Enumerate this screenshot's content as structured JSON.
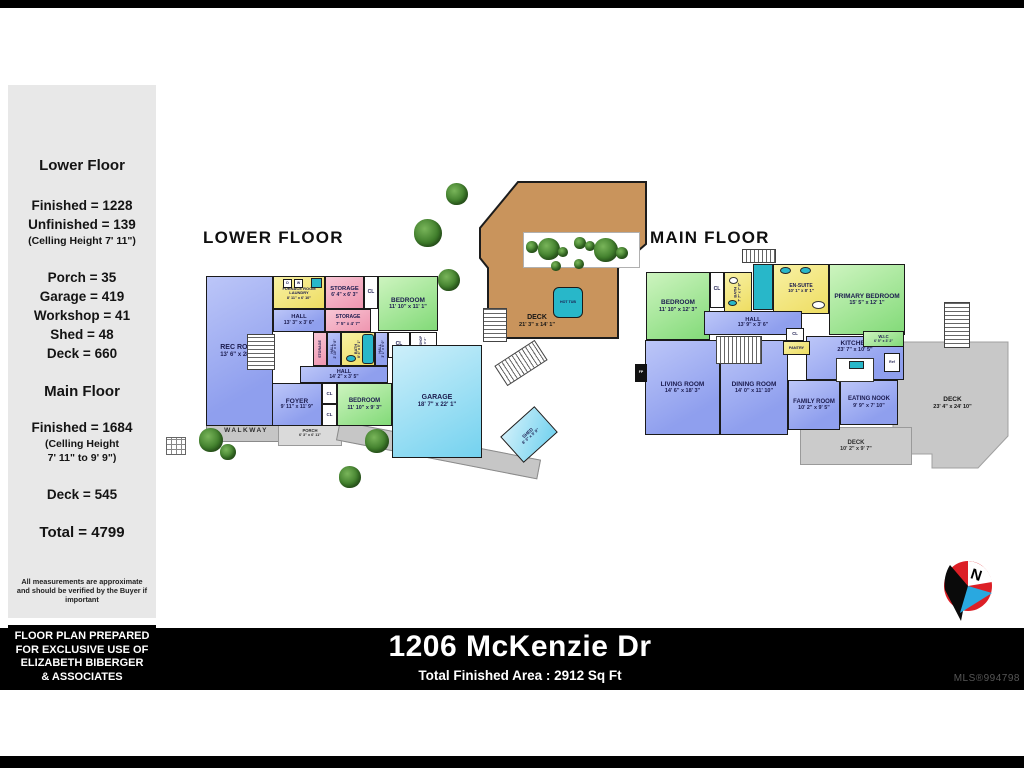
{
  "meta": {
    "address": "1206 McKenzie Dr",
    "total_area_label": "Total Finished Area : 2912 Sq Ft",
    "mls": "MLS®994798"
  },
  "palette": {
    "room_blue": "#8f9fee",
    "room_green": "#82da78",
    "room_yellow": "#eedd62",
    "room_pink": "#ef96b0",
    "room_cyan": "#74d2ef",
    "deck_tan": "#c9945c",
    "deck_gray": "#c8c8c8",
    "fixture_teal": "#28b7c9",
    "wall_black": "#1a1a1a"
  },
  "sidebar": {
    "lower": {
      "title": "Lower Floor",
      "lines": [
        "Finished = 1228",
        "Unfinished = 139"
      ],
      "note": "(Celling Height 7' 11\")",
      "lines2": [
        "Porch = 35",
        "Garage = 419",
        "Workshop = 41",
        "Shed = 48",
        "Deck = 660"
      ]
    },
    "main": {
      "title": "Main Floor",
      "lines": [
        "Finished = 1684"
      ],
      "note": [
        "(Celling Height",
        "7' 11\" to 9' 9\")"
      ],
      "lines2": [
        "Deck = 545"
      ]
    },
    "total": "Total = 4799",
    "disclaimer": "All measurements are approximate and should be verified by the Buyer if important"
  },
  "prepared_notice": [
    "FLOOR PLAN PREPARED",
    "FOR EXCLUSIVE USE OF",
    "ELIZABETH BIBERGER",
    "& ASSOCIATES"
  ],
  "compass": {
    "label": "N"
  },
  "floors": [
    {
      "id": "lower",
      "title": "LOWER FLOOR",
      "rooms": [
        {
          "id": "rec-room",
          "label": "REC ROOM",
          "dims": "13' 6\" x 28' 0\""
        },
        {
          "id": "furnace-laundry",
          "label": "FURNACE ROOM LAUNDRY",
          "dims": "8' 11\" x 6' 10\""
        },
        {
          "id": "storage-top",
          "label": "STORAGE",
          "dims": "6' 4\" x 6' 3\""
        },
        {
          "id": "cl-1",
          "label": "CL"
        },
        {
          "id": "bedroom-upper",
          "label": "BEDROOM",
          "dims": "11' 10\" x 11' 1\""
        },
        {
          "id": "hall-upper",
          "label": "HALL",
          "dims": "13' 3\" x 3' 6\""
        },
        {
          "id": "storage-mid",
          "label": "STORAGE",
          "dims": "7' 5\" x 4' 7\""
        },
        {
          "id": "storage-vert",
          "label": "STORAGE"
        },
        {
          "id": "hall-vert-left",
          "label": "HALL",
          "dims": "2' 10\" x 6' 8\""
        },
        {
          "id": "bath",
          "label": "BATH",
          "dims": "8' 4\" x 5' 1\""
        },
        {
          "id": "hall-vert-right",
          "label": "HALL",
          "dims": "3' 1\" x 6' 0\""
        },
        {
          "id": "cl-2",
          "label": "CL"
        },
        {
          "id": "workshop",
          "label": "WORKSHOP",
          "dims": "6' 4\" x 6' 2\""
        },
        {
          "id": "hall-lower",
          "label": "HALL",
          "dims": "14' 2\" x 3' 5\""
        },
        {
          "id": "foyer",
          "label": "FOYER",
          "dims": "9' 11\" x 11' 9\""
        },
        {
          "id": "cl-3",
          "label": "CL"
        },
        {
          "id": "cl-4",
          "label": "CL"
        },
        {
          "id": "bedroom-lower",
          "label": "BEDROOM",
          "dims": "11' 10\" x 9' 3\""
        },
        {
          "id": "garage",
          "label": "GARAGE",
          "dims": "18' 7\" x 22' 1\""
        },
        {
          "id": "deck",
          "label": "DECK",
          "dims": "21' 3\" x 14' 1\""
        },
        {
          "id": "hot-tub",
          "label": "HOT TUB"
        },
        {
          "id": "shed",
          "label": "SHED",
          "dims": "8' 3\" x 5' 9\""
        },
        {
          "id": "walkway-front",
          "label": "WALKWAY"
        },
        {
          "id": "porch",
          "label": "PORCH",
          "dims": "6' 3\" x 6' 11\""
        },
        {
          "id": "walkway-side",
          "label": "WALKWAY"
        },
        {
          "id": "dryer",
          "label": "D"
        },
        {
          "id": "washer",
          "label": "W"
        }
      ]
    },
    {
      "id": "main",
      "title": "MAIN FLOOR",
      "rooms": [
        {
          "id": "bedroom",
          "label": "BEDROOM",
          "dims": "11' 10\" x 12' 3\""
        },
        {
          "id": "cl-a",
          "label": "CL"
        },
        {
          "id": "bath",
          "label": "BATH",
          "dims": "7' 7\" x 7' 8\""
        },
        {
          "id": "en-suite",
          "label": "EN-SUITE",
          "dims": "10' 1\" x 8' 1\""
        },
        {
          "id": "primary-bedroom",
          "label": "PRIMARY BEDROOM",
          "dims": "15' 5\" x 12' 1\""
        },
        {
          "id": "cl-b",
          "label": "CL"
        },
        {
          "id": "hall",
          "label": "HALL",
          "dims": "13' 9\" x 3' 6\""
        },
        {
          "id": "cl-c",
          "label": "CL"
        },
        {
          "id": "pantry",
          "label": "PANTRY"
        },
        {
          "id": "wic",
          "label": "W.I.C",
          "dims": "6' 5\" x 3' 2\""
        },
        {
          "id": "kitchen",
          "label": "KITCHEN",
          "dims": "23' 7\" x 10' 5\""
        },
        {
          "id": "ref",
          "label": "Ref"
        },
        {
          "id": "living-room",
          "label": "LIVING ROOM",
          "dims": "14' 6\" x 18' 3\""
        },
        {
          "id": "fp",
          "label": "FP"
        },
        {
          "id": "dining-room",
          "label": "DINING ROOM",
          "dims": "14' 0\" x 11' 10\""
        },
        {
          "id": "family-room",
          "label": "FAMILY ROOM",
          "dims": "10' 2\" x 9' 5\""
        },
        {
          "id": "eating-nook",
          "label": "EATING NOOK",
          "dims": "9' 9\" x 7' 10\""
        },
        {
          "id": "deck-small",
          "label": "DECK",
          "dims": "10' 2\" x 9' 7\""
        },
        {
          "id": "deck-large",
          "label": "DECK",
          "dims": "23' 4\" x 24' 10\""
        }
      ]
    }
  ]
}
